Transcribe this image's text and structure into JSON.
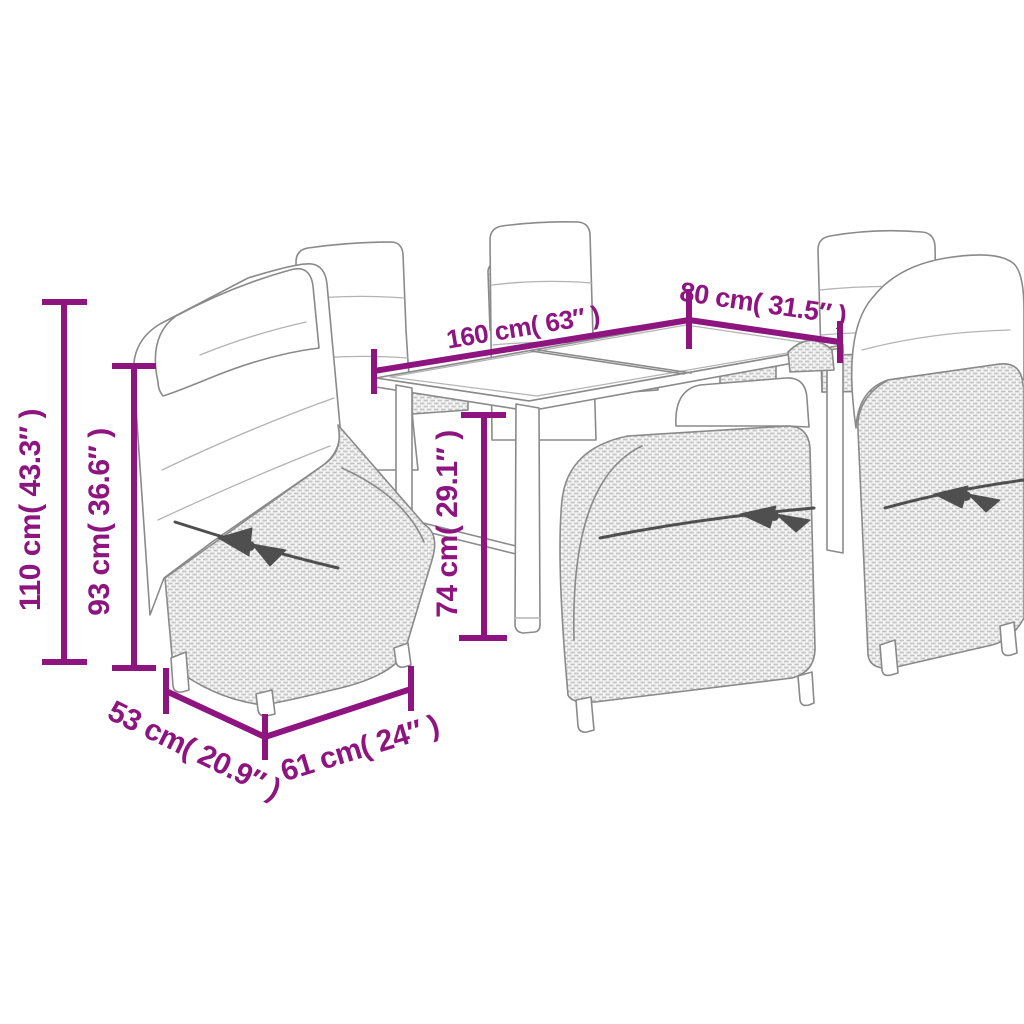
{
  "image": {
    "kind": "product dimension diagram",
    "subject": "7-piece poly rattan garden dining set: rectangular table and six reclining chairs with cushions"
  },
  "colors": {
    "dimension_accent": "#8E1580",
    "background": "#ffffff",
    "line_art": "#8a8a8a",
    "rattan_fill": "#f4f4f4",
    "rattan_texture": "#c3c3c3",
    "strap": "#4f4f4f"
  },
  "dimensions": {
    "table_length": {
      "label": "160 cm( 63″ )"
    },
    "table_width": {
      "label": "80 cm( 31.5″ )"
    },
    "chair_total_height": {
      "label": "110 cm( 43.3″ )"
    },
    "chair_back_height": {
      "label": "93 cm( 36.6″ )"
    },
    "table_height": {
      "label": "74 cm( 29.1″ )"
    },
    "chair_seat_width": {
      "label": "53 cm( 20.9″ )"
    },
    "chair_seat_depth": {
      "label": "61 cm( 24″ )"
    }
  }
}
